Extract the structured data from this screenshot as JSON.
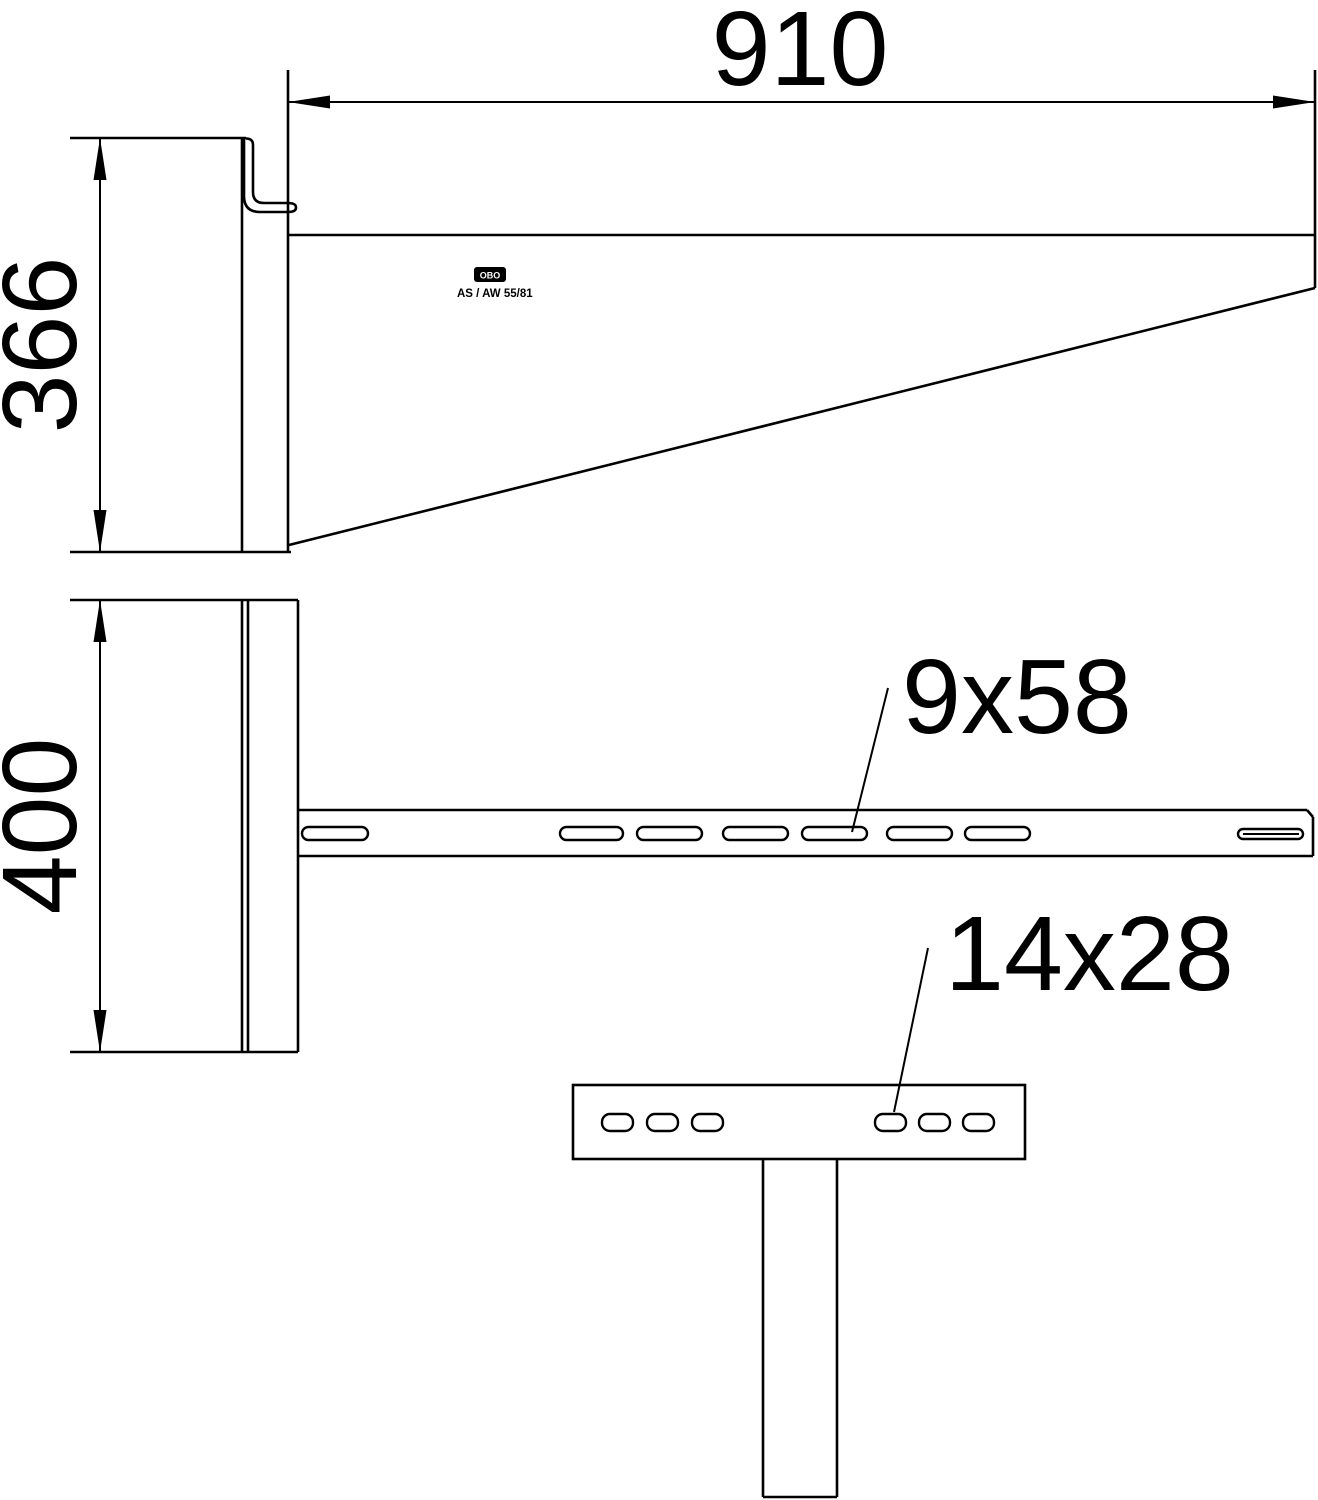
{
  "dimensions": {
    "arm_length": "910",
    "side_height": "366",
    "plate_height": "400"
  },
  "slot_labels": {
    "arm_slot": "9x58",
    "head_plate_slot": "14x28"
  },
  "product_label": {
    "logo_text": "OBO",
    "model_text": "AS / AW 55/81"
  },
  "colors": {
    "line": "#000000",
    "background": "#ffffff"
  }
}
